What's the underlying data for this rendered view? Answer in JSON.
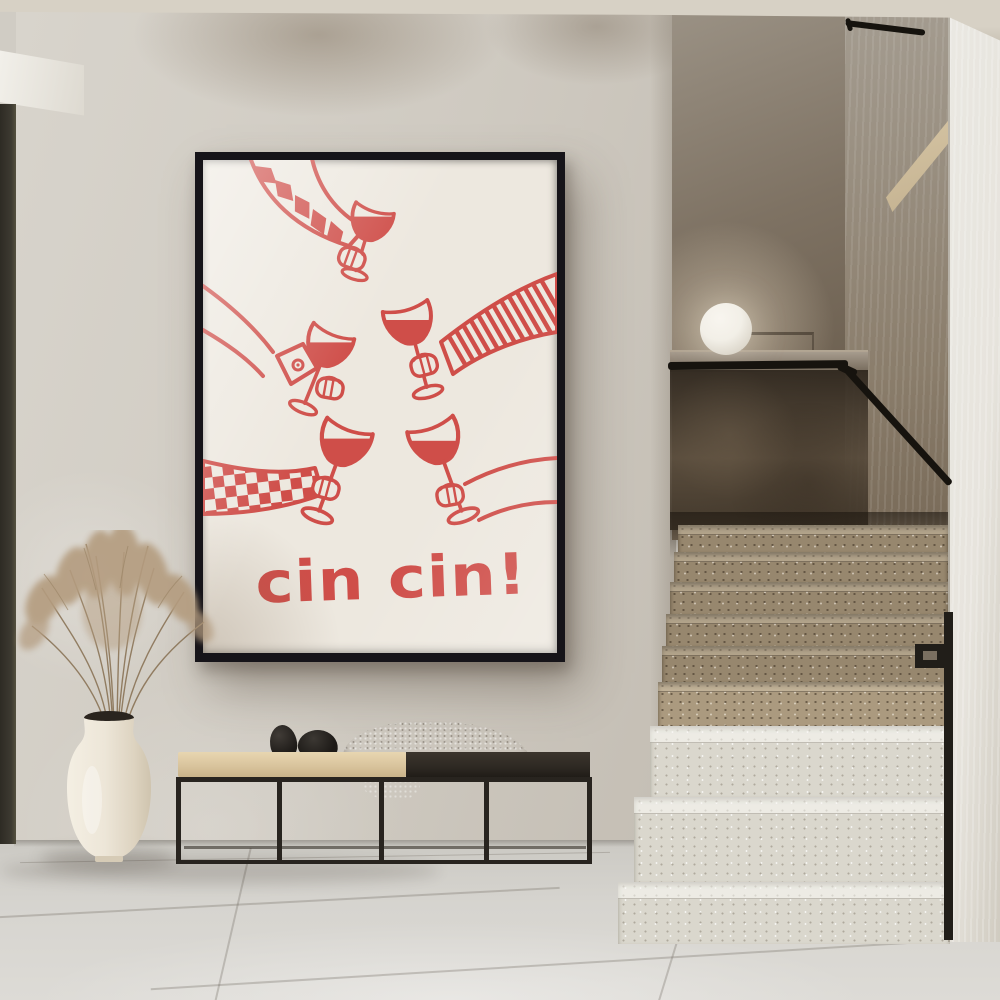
{
  "scene": {
    "label": "minimal interior hallway with wall poster, bench, vase and terrazzo staircase"
  },
  "poster": {
    "text": "cin cin!",
    "motif": "five hands toasting with red wine glasses",
    "sleeve_patterns": [
      "triangle-pattern",
      "plain-cuff-button",
      "diagonal-stripes",
      "checkerboard",
      "plain"
    ]
  },
  "objects": {
    "lamp": "sphere-lamp",
    "plant": "dried-pampas-grass",
    "bench_items": [
      "black-stone-pair",
      "woven-throw-blanket"
    ]
  },
  "colors": {
    "accent_red": "#cf4e49",
    "poster_bg": "#ede8df",
    "frame_black": "#161419",
    "wall": "#cfcac1",
    "ceiling": "#d7d1c5",
    "floor": "#d4d2cd",
    "left_trim": "#3d3a31",
    "column": "#e7e4dd",
    "cushion": "#d9c49d",
    "bench_frame": "#28241f",
    "bench_top": "#2e2923",
    "blanket": "#b7afa2",
    "stone": "#1d1a17",
    "vase": "#ede6d8",
    "grass": "#b29b7f",
    "glass_panel": "#4a4035",
    "steps_upper": "#94846b",
    "steps_lower": "#dad7cd",
    "handrail": "#16130e",
    "lamp": "#f2efe7",
    "wedge": "#d8c7a6"
  }
}
